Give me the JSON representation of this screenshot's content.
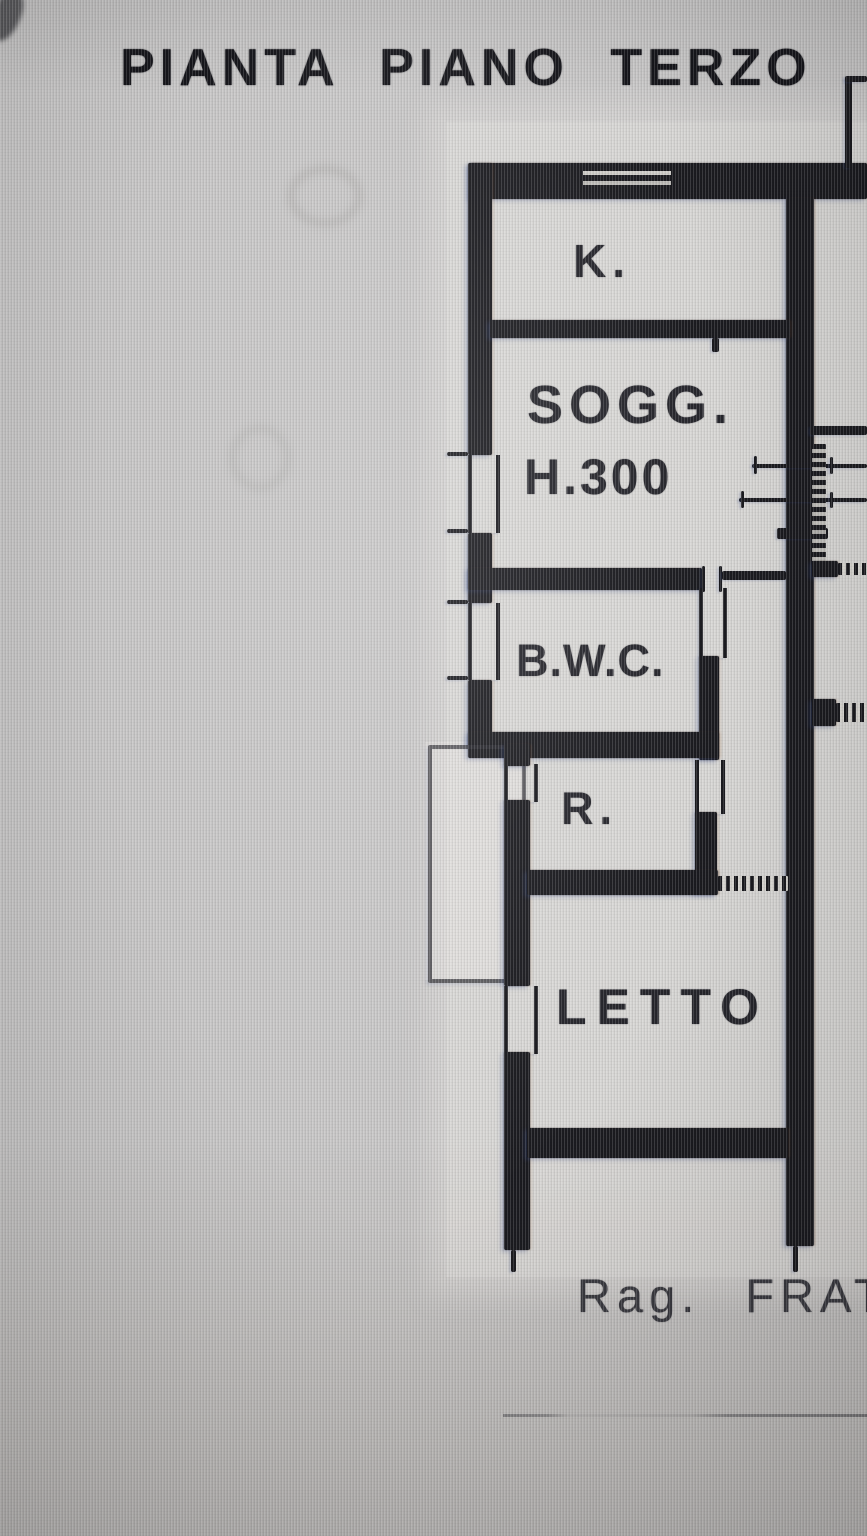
{
  "title": "PIANTA PIANO TERZO",
  "plan": {
    "rooms": [
      {
        "id": "k",
        "label": "K."
      },
      {
        "id": "sogg",
        "label": "SOGG.",
        "height_note": "H.300"
      },
      {
        "id": "bwc",
        "label": "B.W.C."
      },
      {
        "id": "r",
        "label": "R."
      },
      {
        "id": "letto",
        "label": "LETTO"
      }
    ],
    "signature": "Rag. FRAT"
  },
  "colors": {
    "wall": "#1b1b20",
    "paper": "#d6d4cf",
    "background": "#c7c6c6",
    "ink": "#26262c"
  }
}
